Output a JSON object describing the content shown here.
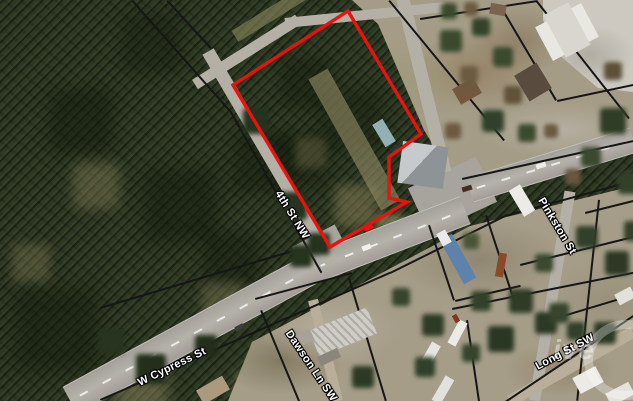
{
  "map": {
    "street_labels": [
      {
        "name": "4th-st-nw",
        "text": "4th St NW"
      },
      {
        "name": "w-cypress-st",
        "text": "W Cypress St"
      },
      {
        "name": "dawson-ln-sw",
        "text": "Dawson Ln SW"
      },
      {
        "name": "pinkston-st",
        "text": "Pinkston St"
      },
      {
        "name": "long-st-sw",
        "text": "Long St SW"
      }
    ],
    "parcel": {
      "outline_color": "#e8120f"
    },
    "watermark": {
      "text": "ive"
    }
  }
}
